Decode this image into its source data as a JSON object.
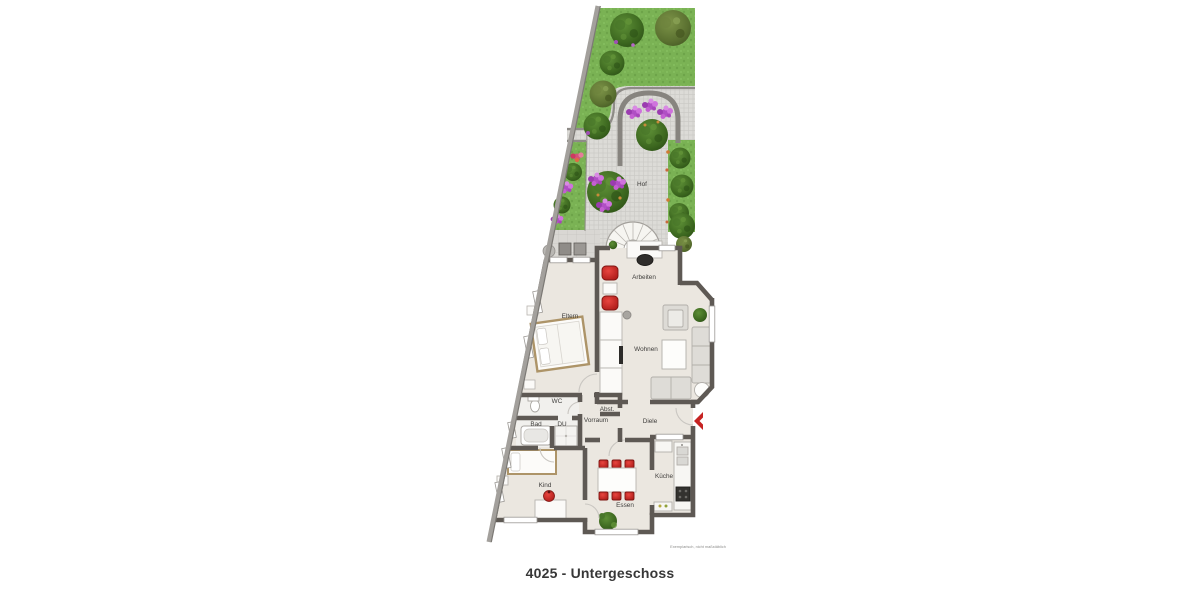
{
  "title": "4025 - Untergeschoss",
  "disclaimer": "Exemplarisch, nicht maßstäblich",
  "rooms": {
    "hof": "Hof",
    "arbeiten": "Arbeiten",
    "eltern": "Eltern",
    "wohnen": "Wohnen",
    "wc": "WC",
    "abst": "Abst.",
    "vorraum": "Vorraum",
    "bad": "Bad",
    "du": "DU",
    "diele": "Diele",
    "kind": "Kind",
    "kueche": "Küche",
    "essen": "Essen"
  },
  "icons": {
    "entrance": "entrance-chevron-icon"
  },
  "colors": {
    "accent_red": "#c62322",
    "wall": "#5e5954",
    "boundary_wall": "#a3a09c",
    "grass": "#7ab254",
    "paving": "#d8d7d3",
    "floor": "#ebe7e0",
    "furniture_outline": "#b7b4af",
    "wood_frame": "#ad9468"
  }
}
